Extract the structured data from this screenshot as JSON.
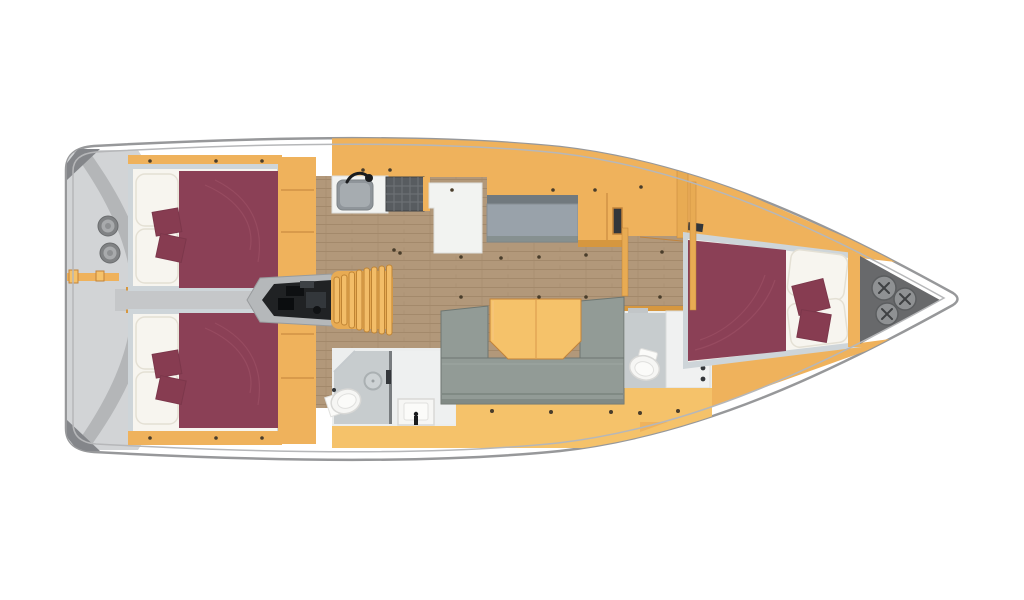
{
  "palette": {
    "hull-stroke": "#97989a",
    "hull-inner": "#b6b7b9",
    "stern-gray": "#d2d4d6",
    "stern-band": "#b4b6b8",
    "wedge": "#84868a",
    "winch-outer": "#808284",
    "winch-mid": "#a8aaac",
    "winch-center": "#8e9092",
    "tan": "#efb25c",
    "tan-bright": "#f5c26a",
    "tan-mid": "#e8ab53",
    "tan-dark": "#d6973f",
    "tan-seam": "#c2833a",
    "wood": "#b2987a",
    "wood-line": "#a3896b",
    "maroon": "#8b4056",
    "maroon-deep": "#7c374b",
    "maroon-light": "#9a4e63",
    "maroon-pillow": "#873c51",
    "bed-white": "#f7f5ef",
    "bed-edge": "#e4e0d4",
    "frame": "#ced5d9",
    "corridor": "#c5c7c9",
    "sofa": "#929b96",
    "sofa-dark": "#7a837e",
    "sofa-edge": "#6d7671",
    "settee": "#99a2aa",
    "settee-back": "#71797e",
    "bath-wall": "#eceeee",
    "bath-floor": "#c7ccce",
    "fixture": "#f6f6f4",
    "fixture-edge": "#d8d8d6",
    "steel": "#8f959a",
    "steel-light": "#a6acb0",
    "ink": "#1a1c1e",
    "engine-bay": "#b5b8ba",
    "engine": "#202224",
    "stove": "#585c60",
    "stove-grid": "#6f7377",
    "locker": "#68696b",
    "locker-circle": "#8f9193",
    "locker-x": "#3f4143",
    "screw": "#493d2b",
    "white": "#ffffff"
  },
  "plan": {
    "vessel": "sailing-yacht-floor-plan",
    "orientation": {
      "bow": "right",
      "stern": "left"
    },
    "rooms": [
      {
        "id": "stern-platform",
        "items": [
          "winch",
          "winch",
          "transom-step"
        ]
      },
      {
        "id": "aft-cabin-port",
        "items": [
          "double-bed",
          "pillow",
          "pillow",
          "throw-pillow",
          "throw-pillow",
          "wardrobe"
        ]
      },
      {
        "id": "aft-cabin-starboard",
        "items": [
          "double-bed",
          "pillow",
          "pillow",
          "throw-pillow",
          "throw-pillow",
          "wardrobe"
        ]
      },
      {
        "id": "engine-room",
        "items": [
          "engine",
          "companionway-stairs"
        ]
      },
      {
        "id": "galley",
        "items": [
          "sink",
          "faucet",
          "stove",
          "refrigerator-counter"
        ]
      },
      {
        "id": "salon",
        "items": [
          "side-settee",
          "u-sofa",
          "dining-table"
        ]
      },
      {
        "id": "aft-head",
        "items": [
          "toilet",
          "shower-drain",
          "washbasin"
        ]
      },
      {
        "id": "forward-head",
        "items": [
          "toilet",
          "vanity-sink"
        ]
      },
      {
        "id": "forward-cabin",
        "items": [
          "double-bed",
          "pillow",
          "pillow",
          "throw-pillow",
          "throw-pillow"
        ]
      },
      {
        "id": "anchor-locker",
        "items": [
          "deck-fitting",
          "deck-fitting",
          "deck-fitting"
        ]
      }
    ]
  }
}
